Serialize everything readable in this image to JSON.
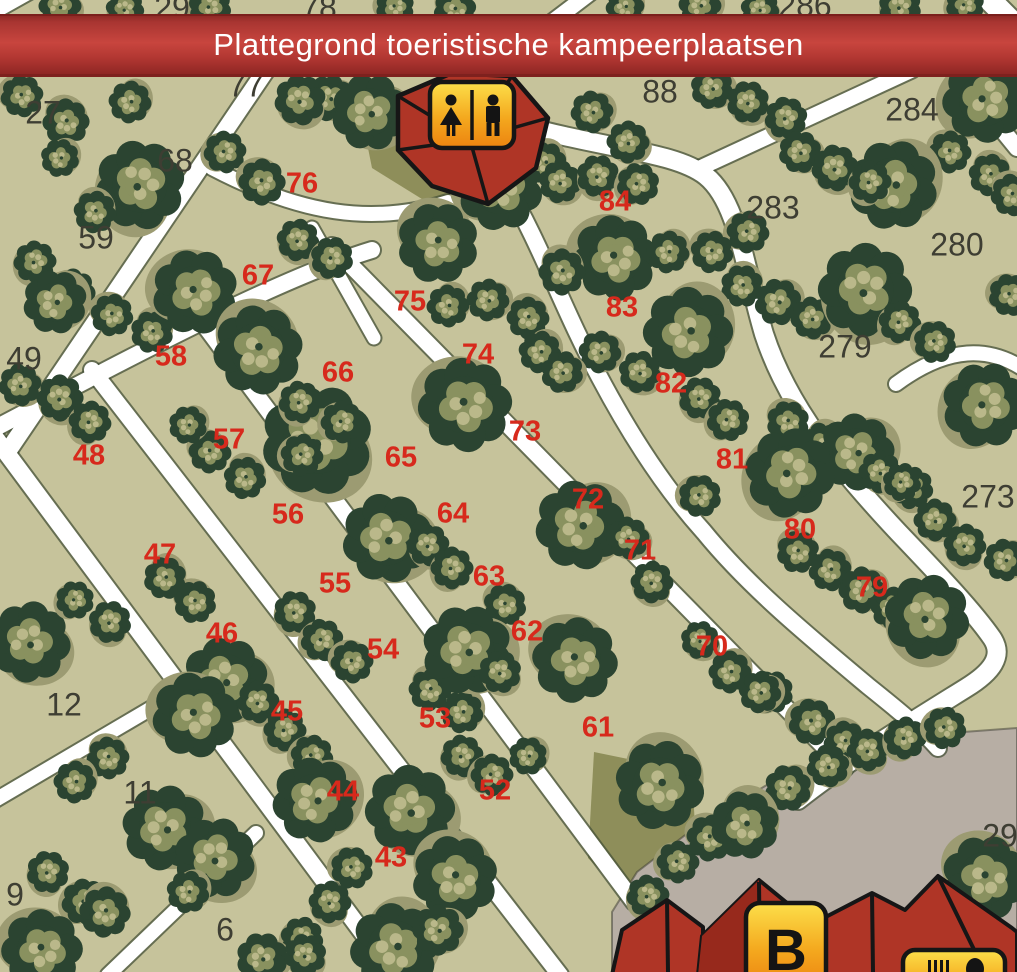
{
  "title_banner": {
    "text": "Plattegrond toeristische kampeerplaatsen",
    "background": "#b5392f",
    "text_color": "#ffffff"
  },
  "map": {
    "background_color": "#c6c39b",
    "path_color": "#ffffff",
    "tree_dark_green": "#2b4431",
    "tree_olive": "#89915f",
    "parking_gray": "#b7aea4",
    "pitch_number_color": "#d7291c",
    "area_number_color": "#3e3e33",
    "building_red": "#af3526",
    "sign_gradient_top": "#fcdf4a",
    "sign_gradient_bottom": "#ec8310"
  },
  "plots": {
    "red": [
      {
        "label": "43",
        "x": 391,
        "y": 858
      },
      {
        "label": "44",
        "x": 343,
        "y": 792
      },
      {
        "label": "45",
        "x": 287,
        "y": 712
      },
      {
        "label": "46",
        "x": 222,
        "y": 634
      },
      {
        "label": "47",
        "x": 160,
        "y": 555
      },
      {
        "label": "48",
        "x": 89,
        "y": 456
      },
      {
        "label": "52",
        "x": 495,
        "y": 791
      },
      {
        "label": "53",
        "x": 435,
        "y": 719
      },
      {
        "label": "54",
        "x": 383,
        "y": 650
      },
      {
        "label": "55",
        "x": 335,
        "y": 584
      },
      {
        "label": "56",
        "x": 288,
        "y": 515
      },
      {
        "label": "57",
        "x": 229,
        "y": 440
      },
      {
        "label": "58",
        "x": 171,
        "y": 357
      },
      {
        "label": "61",
        "x": 598,
        "y": 728
      },
      {
        "label": "62",
        "x": 527,
        "y": 632
      },
      {
        "label": "63",
        "x": 489,
        "y": 577
      },
      {
        "label": "64",
        "x": 453,
        "y": 514
      },
      {
        "label": "65",
        "x": 401,
        "y": 458
      },
      {
        "label": "66",
        "x": 338,
        "y": 373
      },
      {
        "label": "67",
        "x": 258,
        "y": 276
      },
      {
        "label": "70",
        "x": 712,
        "y": 647
      },
      {
        "label": "71",
        "x": 640,
        "y": 551
      },
      {
        "label": "72",
        "x": 588,
        "y": 500
      },
      {
        "label": "73",
        "x": 525,
        "y": 432
      },
      {
        "label": "74",
        "x": 478,
        "y": 355
      },
      {
        "label": "75",
        "x": 410,
        "y": 302
      },
      {
        "label": "76",
        "x": 302,
        "y": 184
      },
      {
        "label": "79",
        "x": 872,
        "y": 588
      },
      {
        "label": "80",
        "x": 800,
        "y": 530
      },
      {
        "label": "81",
        "x": 732,
        "y": 460
      },
      {
        "label": "82",
        "x": 671,
        "y": 384
      },
      {
        "label": "83",
        "x": 622,
        "y": 308
      },
      {
        "label": "84",
        "x": 615,
        "y": 202
      }
    ],
    "dark": [
      {
        "label": "6",
        "x": 225,
        "y": 930
      },
      {
        "label": "9",
        "x": 15,
        "y": 895
      },
      {
        "label": "11",
        "x": 140,
        "y": 793
      },
      {
        "label": "12",
        "x": 64,
        "y": 705
      },
      {
        "label": "27",
        "x": 43,
        "y": 113
      },
      {
        "label": "29",
        "x": 172,
        "y": 8
      },
      {
        "label": "49",
        "x": 24,
        "y": 359
      },
      {
        "label": "59",
        "x": 96,
        "y": 238
      },
      {
        "label": "68",
        "x": 175,
        "y": 161
      },
      {
        "label": "77",
        "x": 246,
        "y": 86
      },
      {
        "label": "78",
        "x": 319,
        "y": 8
      },
      {
        "label": "88",
        "x": 660,
        "y": 92
      },
      {
        "label": "273",
        "x": 988,
        "y": 497
      },
      {
        "label": "279",
        "x": 845,
        "y": 347
      },
      {
        "label": "280",
        "x": 957,
        "y": 245
      },
      {
        "label": "283",
        "x": 773,
        "y": 208
      },
      {
        "label": "284",
        "x": 912,
        "y": 110
      },
      {
        "label": "286",
        "x": 805,
        "y": 6
      },
      {
        "label": "29",
        "x": 1000,
        "y": 836
      }
    ]
  },
  "facilities": [
    {
      "id": "toilets",
      "sign_label": "",
      "icons": [
        "woman-icon",
        "man-icon"
      ]
    },
    {
      "id": "building-b",
      "sign_label": "B",
      "icons": []
    },
    {
      "id": "restaurant",
      "sign_label": "",
      "icons": [
        "fork-icon",
        "spoon-icon"
      ]
    }
  ]
}
